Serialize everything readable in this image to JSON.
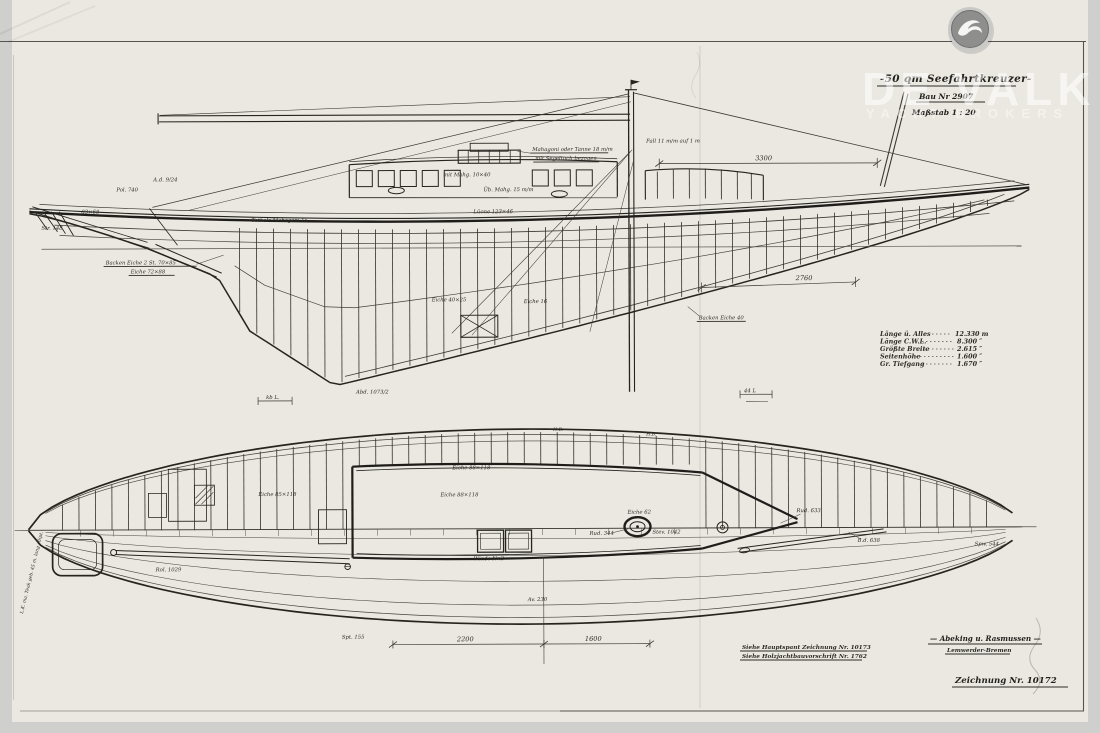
{
  "brand": {
    "logo_icon": "devalk-bird-icon",
    "watermark": "DE VALK",
    "watermark_sub": "YACHT BROKERS"
  },
  "title_block": {
    "title": "-50 qm Seefahrtkreuzer-",
    "build_no": "Bau Nr 2907",
    "scale": "Maßstab  1 : 20"
  },
  "specs": {
    "rows": [
      {
        "label": "Länge ü. Alles",
        "value": "12.330 m"
      },
      {
        "label": "Länge C.W.L.",
        "value": "8.300 ″"
      },
      {
        "label": "Größte Breite",
        "value": "2.615 ″"
      },
      {
        "label": "Seitenhöhe",
        "value": "1.600 ″"
      },
      {
        "label": "Gr. Tiefgang",
        "value": "1.670 ″"
      }
    ]
  },
  "side_view": {
    "labels": {
      "pol_740": "Pol. 740",
      "ad_924": "A.d. 9/24",
      "dim_83x68": "83×68",
      "str_148": "Str. 148",
      "backen_eiche": "Backen Eiche 2 St. 70×85",
      "eiche_72x88": "Eiche 72×88",
      "totholz": "Totholz Mahagoni 15",
      "mahagoni_tanne_1": "Mahagoni oder Tanne 18 m/m",
      "mahagoni_tanne_2": "mit Segeltuch bezogen",
      "mit_mahg": "mit Mahg. 10×40",
      "ub_mahg": "Üb. Mahg. 15 m/m",
      "luone": "Lüone 123×46",
      "fall": "Fall 11 m/m auf 1 m",
      "eiche_40x25": "Eiche 40×25",
      "eiche_16": "Eiche 16",
      "backen_eiche_40": "Backen Eiche 40",
      "abd_1073": "Abd. 1073/2",
      "kb_l": "kb L.",
      "l_44": "44 L",
      "dim_3300": "3300",
      "dim_2760": "2760"
    }
  },
  "plan_view": {
    "labels": {
      "eiche_88x118_a": "Eiche 88×118",
      "eiche_85x118": "Eiche 85×118",
      "eiche_88x118_b": "Eiche 88×118",
      "winde_nr2": "Winde Nr.2",
      "eiche_62": "Eiche 62",
      "rud_344": "Rud. 344",
      "stev_1042": "Stev. 1042",
      "rud_633": "Rud. 633",
      "bd_638": "B.d. 638",
      "spw_544": "Spw. 544",
      "rol_1029": "Rol. 1029",
      "spt_155": "Spt. 155",
      "av_230": "Av. 230",
      "hb_1": "H.B.",
      "hb_2": "H.B.",
      "teak_note": "L.K. ma. Teak geb. 45 m. lang ellipt.",
      "dim_2200": "2200",
      "dim_1600": "1600"
    }
  },
  "footer": {
    "note_1": "Siehe Hauptspant Zeichnung Nr. 10173",
    "note_2": "Siehe Holzjachtbauvorschrift Nr. 1762",
    "yard_name": "— Abeking u. Rasmussen —",
    "yard_city": "Lemwerder-Bremen",
    "drawing_no": "Zeichnung Nr. 10172"
  },
  "colors": {
    "paper": "#ebe8e2",
    "ink": "#2c2a26",
    "margin_gray": "#cfcfcd",
    "watermark": "#ffffff"
  }
}
